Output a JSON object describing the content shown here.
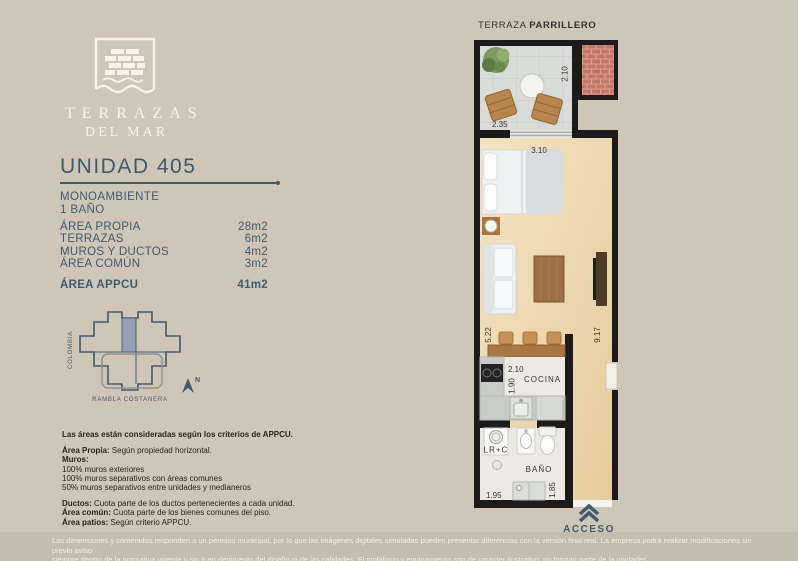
{
  "brand": {
    "line1": "TERRAZAS",
    "line2": "DEL MAR"
  },
  "unit": {
    "title": "UNIDAD 405",
    "type_line1": "MONOAMBIENTE",
    "type_line2": "1 BAÑO",
    "areas": [
      {
        "label": "ÁREA PROPIA",
        "value": "28m2"
      },
      {
        "label": "TERRAZAS",
        "value": "6m2"
      },
      {
        "label": "MUROS Y DUCTOS",
        "value": "4m2"
      },
      {
        "label": "ÁREA COMÚN",
        "value": "3m2"
      }
    ],
    "total": {
      "label": "ÁREA APPCU",
      "value": "41m2"
    }
  },
  "map": {
    "street_left": "COLOMBIA",
    "street_bottom": "RAMBLA COSTANERA",
    "north": "N"
  },
  "criteria": {
    "title": "Las áreas están consideradas según los criterios de APPCU.",
    "block1": [
      {
        "b": "Área Propia:",
        "t": " Según propiedad horizontal."
      },
      {
        "b": "Muros:",
        "t": ""
      },
      {
        "b": "",
        "t": "100% muros exteriores"
      },
      {
        "b": "",
        "t": "100% muros separativos con áreas comunes"
      },
      {
        "b": "",
        "t": "50% muros separativos entre unidades y medianeros"
      }
    ],
    "block2": [
      {
        "b": "Ductos:",
        "t": "  Cuota parte de los ductos pertenecientes a cada unidad."
      },
      {
        "b": "Área común:",
        "t": " Cuota parte de los bienes comunes del piso."
      },
      {
        "b": "Área patios:",
        "t": " Según criterio APPCU."
      }
    ]
  },
  "plan": {
    "header": {
      "regular": "TERRAZA",
      "bold": "PARRILLERO"
    },
    "labels": {
      "cocina": "COCINA",
      "bano": "BAÑO",
      "lrc": "LR+C",
      "acceso": "ACCESO"
    },
    "dims": {
      "terrace_depth": "2.10",
      "terrace_width": "2.35",
      "bed_width": "3.10",
      "living_left": "5.22",
      "living_right": "9.17",
      "kitchen_width": "2.10",
      "kitchen_depth": "1.90",
      "bath_width": "1.95",
      "bath_depth": "1.85"
    }
  },
  "footer": {
    "line1": "Las dimensiones y contenidos responden a un permiso municipal, por lo que las imágenes digitales simuladas pueden presentar diferencias con la versión final real. La empresa podrá realizar modificaciones sin previo aviso",
    "line2": "siempre dentro de la normativa vigente y sin ir en detrimento del diseño ni de las calidades. El mobiliario y equipamiento son de carácter ilustrativo, no forman parte de la unidades."
  },
  "colors": {
    "background": "#CFC6B8",
    "footer_bar": "#C6BCAE",
    "accent_blue": "#3D5A70",
    "wall_black": "#1B1B1B",
    "wood_floor": "#EBD5AC",
    "brick": "#C4766A",
    "logo_cream": "#F7F3EA"
  }
}
